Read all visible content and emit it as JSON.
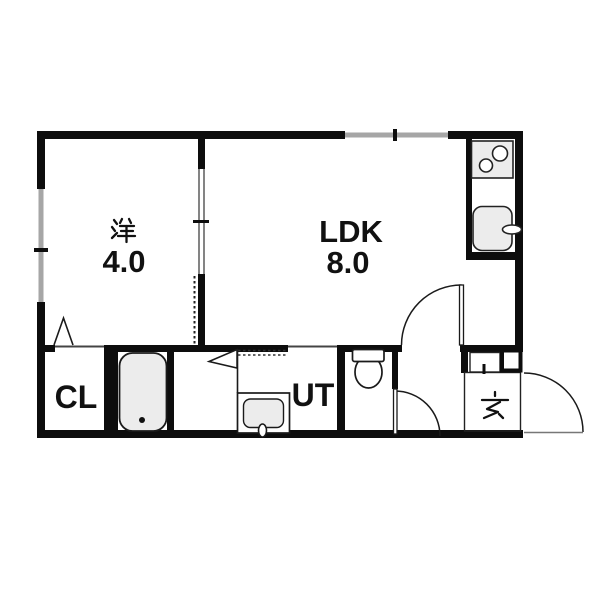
{
  "floorplan": {
    "rooms": {
      "western": {
        "label": "洋",
        "size": "4.0"
      },
      "ldk": {
        "label": "LDK",
        "size": "8.0"
      },
      "closet": {
        "label": "CL"
      },
      "utility": {
        "label": "UT"
      },
      "entrance": {
        "label": "玄"
      }
    },
    "fixtures": [
      "kitchen-stove",
      "kitchen-sink",
      "bathtub",
      "toilet",
      "washbasin",
      "washing-machine-space"
    ],
    "colors": {
      "wall": "#0d0d0d",
      "window": "#a6a6a6",
      "fixture_fill": "#ececec",
      "background": "#ffffff"
    }
  }
}
